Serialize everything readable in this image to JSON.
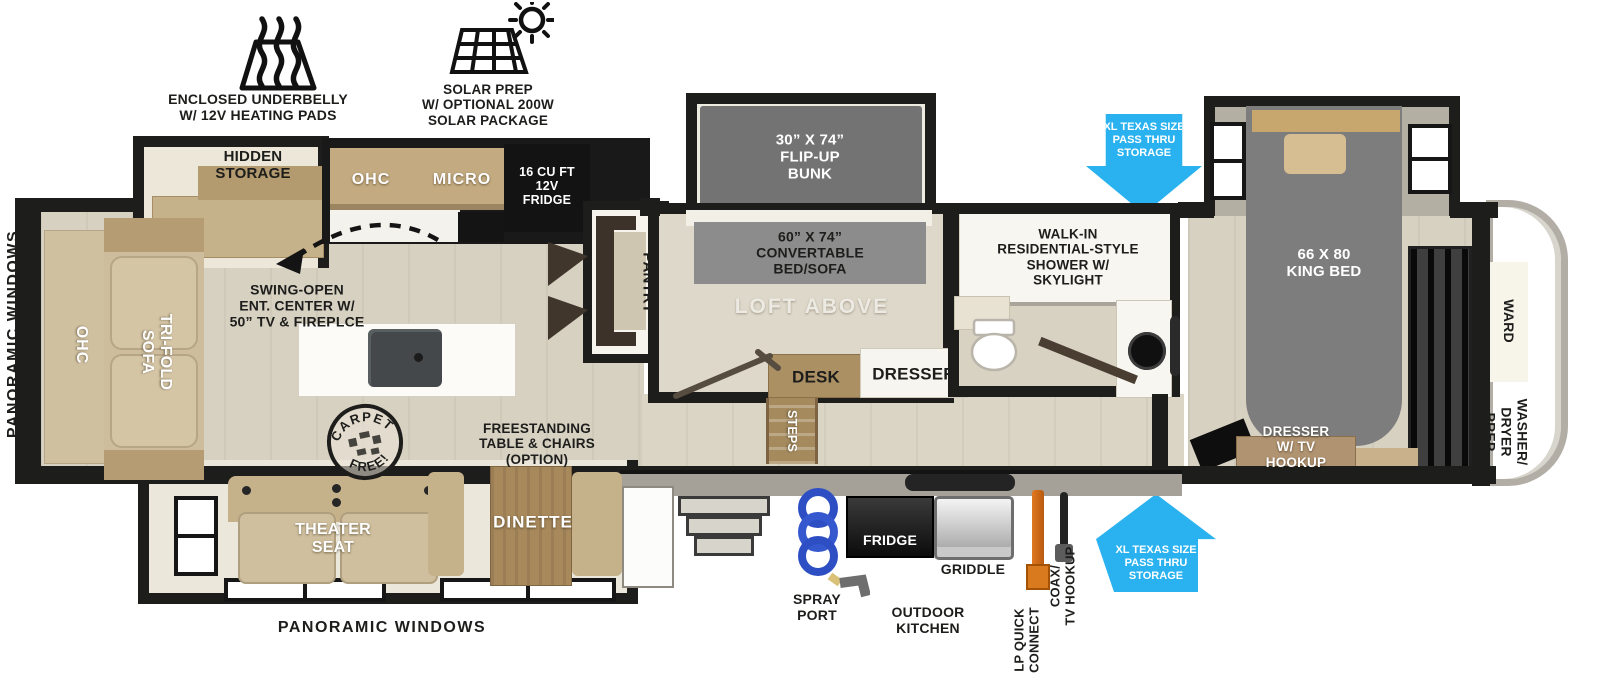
{
  "icons_legend": {
    "underbelly_label": "ENCLOSED UNDERBELLY\nW/ 12V HEATING PADS",
    "solar_label": "SOLAR PREP\nW/ OPTIONAL 200W\nSOLAR PACKAGE"
  },
  "exterior": {
    "panoramic_left": "PANORAMIC WINDOWS",
    "panoramic_bottom": "PANORAMIC WINDOWS",
    "pass_thru_front": "XL TEXAS SIZE\nPASS THRU\nSTORAGE",
    "pass_thru_rear": "XL TEXAS SIZE\nPASS THRU\nSTORAGE",
    "arrow_color": "#29b2ef"
  },
  "living_area": {
    "hidden_storage": "HIDDEN\nSTORAGE",
    "ohc_rear": "OHC",
    "tri_fold_sofa": "TRI-FOLD\nSOFA",
    "ent_center": "SWING-OPEN\nENT. CENTER W/\n50” TV & FIREPLCE",
    "theater_seat": "THEATER\nSEAT",
    "dinette": "DINETTE",
    "freestanding_table": "FREESTANDING\nTABLE & CHAIRS\n(OPTION)",
    "carpet_badge_top": "CARPET",
    "carpet_badge_bottom": "FREE!"
  },
  "kitchen": {
    "ohc": "OHC",
    "micro": "MICRO",
    "fridge": "16 CU FT\n12V\nFRIDGE",
    "pantry": "PANTRY"
  },
  "bunk_room": {
    "flip_up_bunk": "30” X 74”\nFLIP-UP\nBUNK",
    "convertible_bed": "60” X 74”\nCONVERTABLE\nBED/SOFA",
    "loft": "LOFT ABOVE",
    "desk": "DESK",
    "dresser": "DRESSER",
    "steps": "STEPS"
  },
  "bathroom": {
    "shower": "WALK-IN\nRESIDENTIAL-STYLE\nSHOWER W/\nSKYLIGHT"
  },
  "bedroom": {
    "king_bed": "66 X 80\nKING BED",
    "wardrobe": "WARD",
    "washer_dryer": "WASHER/\nDRYER\nPREP",
    "dresser_tv": "DRESSER\nW/ TV\nHOOKUP"
  },
  "outdoor_kitchen": {
    "spray_port": "SPRAY\nPORT",
    "title": "OUTDOOR\nKITCHEN",
    "fridge": "FRIDGE",
    "griddle": "GRIDDLE",
    "lp_quick_connect": "LP QUICK\nCONNECT",
    "coax_tv": "COAX/\nTV HOOKUP"
  }
}
